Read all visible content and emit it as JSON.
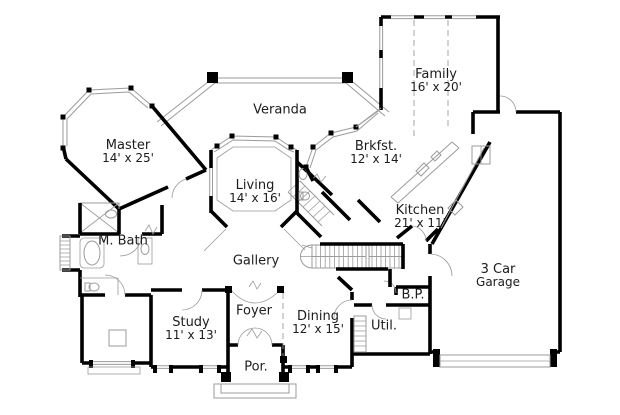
{
  "plan": {
    "colors": {
      "background": "#ffffff",
      "walls": "#000000",
      "lines": "#9b9b9b",
      "text": "#1c1c1c"
    },
    "rooms": [
      {
        "id": "veranda",
        "label": "Veranda",
        "sublabel": ""
      },
      {
        "id": "master",
        "label": "Master",
        "sublabel": "14' x 25'"
      },
      {
        "id": "living",
        "label": "Living",
        "sublabel": "14' x 16'"
      },
      {
        "id": "family",
        "label": "Family",
        "sublabel": "16' x 20'"
      },
      {
        "id": "brkfst",
        "label": "Brkfst.",
        "sublabel": "12' x 14'"
      },
      {
        "id": "kitchen",
        "label": "Kitchen",
        "sublabel": "21' x 11'"
      },
      {
        "id": "mbath",
        "label": "M. Bath",
        "sublabel": ""
      },
      {
        "id": "gallery",
        "label": "Gallery",
        "sublabel": ""
      },
      {
        "id": "study",
        "label": "Study",
        "sublabel": "11' x 13'"
      },
      {
        "id": "foyer",
        "label": "Foyer",
        "sublabel": ""
      },
      {
        "id": "dining",
        "label": "Dining",
        "sublabel": "12' x 15'"
      },
      {
        "id": "porch",
        "label": "Por.",
        "sublabel": ""
      },
      {
        "id": "bp",
        "label": "B.P.",
        "sublabel": ""
      },
      {
        "id": "util",
        "label": "Util.",
        "sublabel": ""
      },
      {
        "id": "garage",
        "label": "3 Car",
        "sublabel": "Garage"
      }
    ]
  }
}
